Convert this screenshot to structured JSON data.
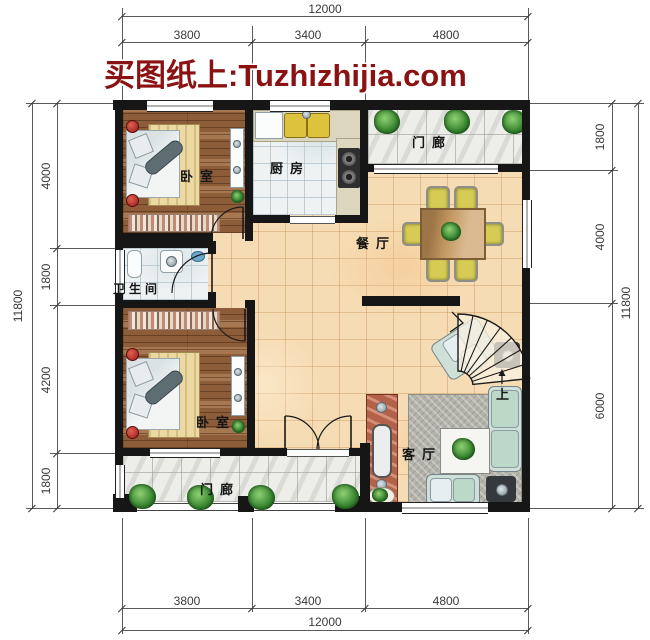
{
  "watermark": {
    "text": "买图纸上:Tuzhizhijia.com",
    "color": "#8b1212"
  },
  "rooms": {
    "bedroom_top": {
      "label": "卧室"
    },
    "kitchen": {
      "label": "厨房"
    },
    "porch_top": {
      "label": "门廊"
    },
    "dining": {
      "label": "餐厅"
    },
    "bathroom": {
      "label": "卫生间"
    },
    "bedroom_bottom": {
      "label": "卧室"
    },
    "porch_bottom": {
      "label": "门廊"
    },
    "living": {
      "label": "客厅"
    },
    "stairs": {
      "up_label": "上"
    }
  },
  "dimensions": {
    "top": {
      "total": "12000",
      "segments": [
        "3800",
        "3400",
        "4800"
      ]
    },
    "bottom": {
      "total": "12000",
      "segments": [
        "3800",
        "3400",
        "4800"
      ]
    },
    "left": {
      "total": "11800",
      "segments": [
        "4000",
        "1800",
        "4200",
        "1800"
      ]
    },
    "right": {
      "total": "11800",
      "segments": [
        "1800",
        "4000",
        "6000"
      ]
    }
  },
  "colors": {
    "wall": "#161616",
    "floor_main": "#f6dcb4",
    "floor_wood": "#8d5c38",
    "floor_tile": "#eef2f3",
    "floor_marble": "#ededea",
    "watermark_red": "#8b1212"
  }
}
